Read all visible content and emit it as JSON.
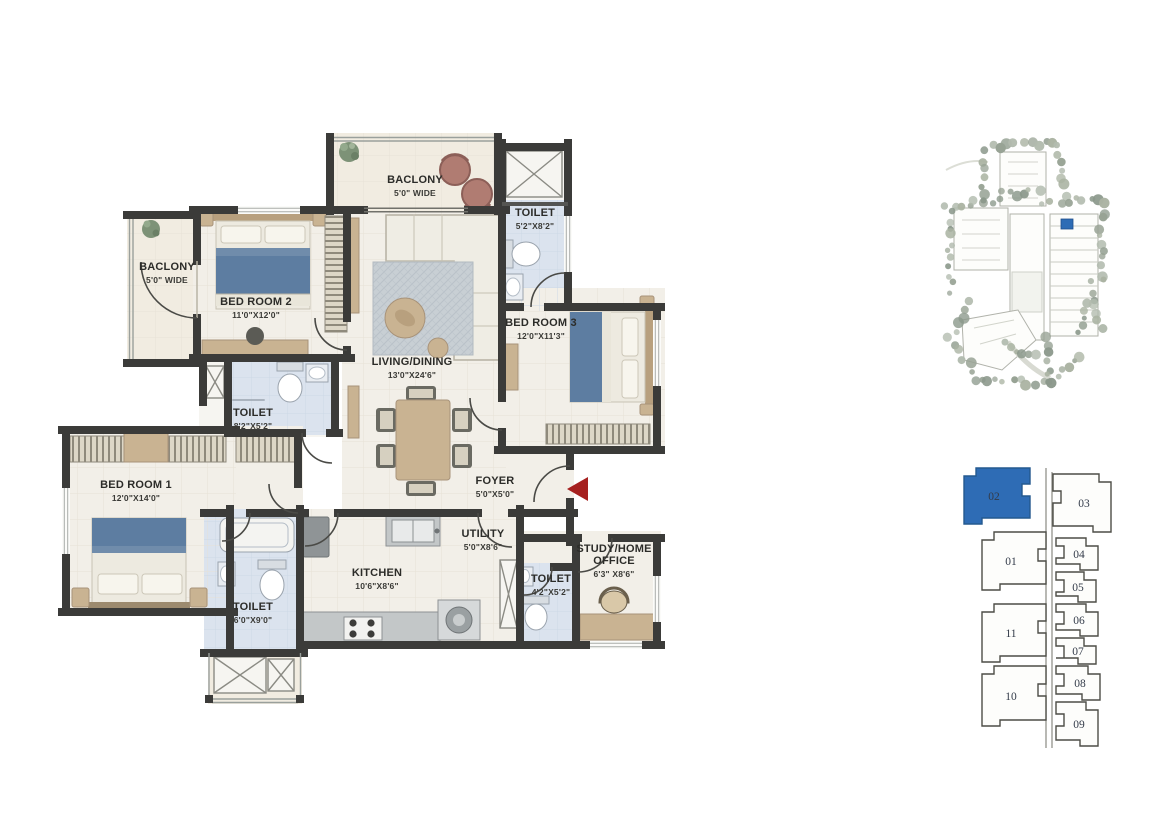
{
  "floorplan": {
    "rooms": [
      {
        "name": "BACLONY",
        "dim": "5'0\" WIDE"
      },
      {
        "name": "TOILET",
        "dim": "5'2\"X8'2\""
      },
      {
        "name": "BACLONY",
        "dim": "5'0\" WIDE"
      },
      {
        "name": "BED ROOM 2",
        "dim": "11'0\"X12'0\""
      },
      {
        "name": "LIVING/DINING",
        "dim": "13'0\"X24'6\""
      },
      {
        "name": "BED ROOM 3",
        "dim": "12'0\"X11'3\""
      },
      {
        "name": "TOILET",
        "dim": "8'2\"X5'2\""
      },
      {
        "name": "BED ROOM 1",
        "dim": "12'0\"X14'0\""
      },
      {
        "name": "FOYER",
        "dim": "5'0\"X5'0\""
      },
      {
        "name": "KITCHEN",
        "dim": "10'6\"X8'6\""
      },
      {
        "name": "UTILITY",
        "dim": "5'0\"X8'6\""
      },
      {
        "name": "TOILET",
        "dim": "6'0\"X9'0\""
      },
      {
        "name": "TOILET",
        "dim": "4'2\"X5'2\""
      },
      {
        "name": "STUDY/HOME OFFICE",
        "dim": "6'3\" X8'6\""
      }
    ],
    "entry_arrow": {
      "direction": "left",
      "color": "#a6201f"
    },
    "wall_color": "#3b3b39",
    "toilet_floor_color": "#dbe3ee"
  },
  "keyplan": {
    "highlighted_unit": "02",
    "highlight_color": "#2e6cb5",
    "units": [
      {
        "label": "02",
        "highlighted": true
      },
      {
        "label": "03",
        "highlighted": false
      },
      {
        "label": "01",
        "highlighted": false
      },
      {
        "label": "04",
        "highlighted": false
      },
      {
        "label": "05",
        "highlighted": false
      },
      {
        "label": "11",
        "highlighted": false
      },
      {
        "label": "06",
        "highlighted": false
      },
      {
        "label": "07",
        "highlighted": false
      },
      {
        "label": "10",
        "highlighted": false
      },
      {
        "label": "08",
        "highlighted": false
      },
      {
        "label": "09",
        "highlighted": false
      }
    ]
  },
  "siteplan": {
    "marker_color": "#2e6cb5"
  }
}
